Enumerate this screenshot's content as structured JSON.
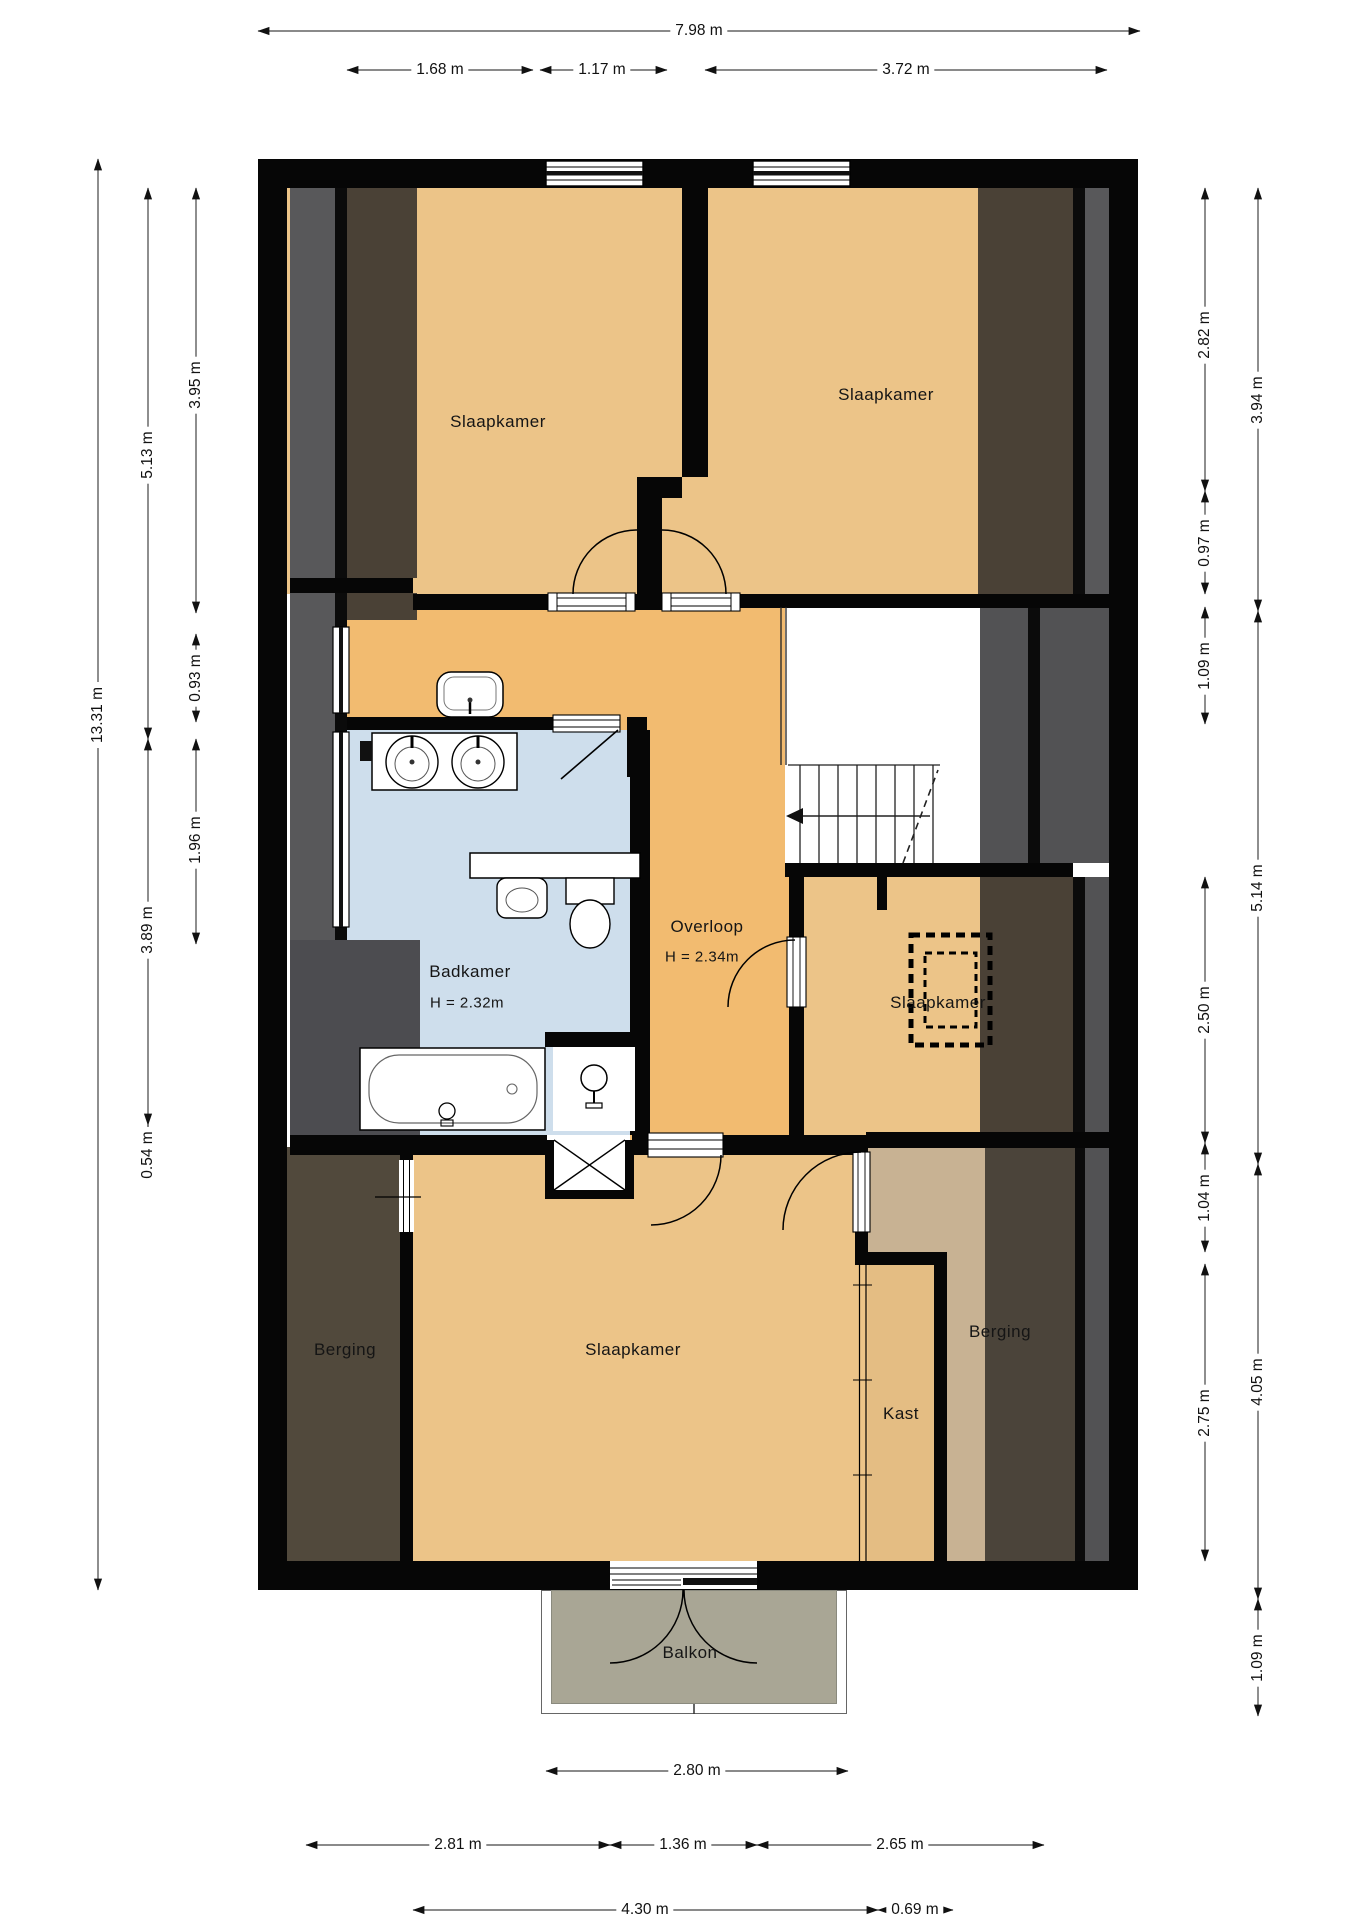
{
  "rooms": {
    "bedroom_top_left": {
      "label": "Slaapkamer"
    },
    "bedroom_top_right": {
      "label": "Slaapkamer"
    },
    "bathroom": {
      "label": "Badkamer",
      "height": "H = 2.32m"
    },
    "landing": {
      "label": "Overloop",
      "height": "H = 2.34m"
    },
    "bedroom_middle": {
      "label": "Slaapkamer"
    },
    "storage_left": {
      "label": "Berging"
    },
    "bedroom_bottom": {
      "label": "Slaapkamer"
    },
    "closet": {
      "label": "Kast"
    },
    "storage_right": {
      "label": "Berging"
    },
    "balcony": {
      "label": "Balkon"
    }
  },
  "dimensions": {
    "top": {
      "total": "7.98 m",
      "segments": [
        "1.68 m",
        "1.17 m",
        "3.72 m"
      ]
    },
    "left": {
      "total": "13.31 m",
      "col_mid": [
        "5.13 m",
        "3.89 m",
        "0.54 m"
      ],
      "col_inner": [
        "3.95 m",
        "0.93 m",
        "1.96 m"
      ]
    },
    "right": {
      "col_inner": [
        "2.82 m",
        "0.97 m",
        "1.09 m",
        "2.50 m",
        "1.04 m",
        "2.75 m"
      ],
      "col_outer": [
        "3.94 m",
        "5.14 m",
        "4.05 m",
        "1.09 m"
      ]
    },
    "bottom": {
      "row_top": "2.80 m",
      "row_mid": [
        "2.81 m",
        "1.36 m",
        "2.65 m"
      ],
      "row_bottom": [
        "4.30 m",
        "0.69 m"
      ]
    }
  },
  "icons": {
    "stairs_direction_arrow": "left-arrow",
    "shower_head": "circle-with-stem",
    "roof_hatch": "dashed-rectangle"
  },
  "colors": {
    "floor_orange": "#ECC488",
    "floor_corridor": "#F2BB70",
    "floor_bathroom": "#CEDEEC",
    "floor_balcony": "#A9A695",
    "floor_storage_right": "#C8B293",
    "floor_closet": "#E4BD83",
    "band_gray": "#58585A",
    "band_brown": "#4A4136",
    "overlay_dark_left": "#51493C",
    "overlay_dark_bath": "#4C4C50",
    "overlay_dark_right": "#4B443A",
    "wall": "#060606"
  }
}
